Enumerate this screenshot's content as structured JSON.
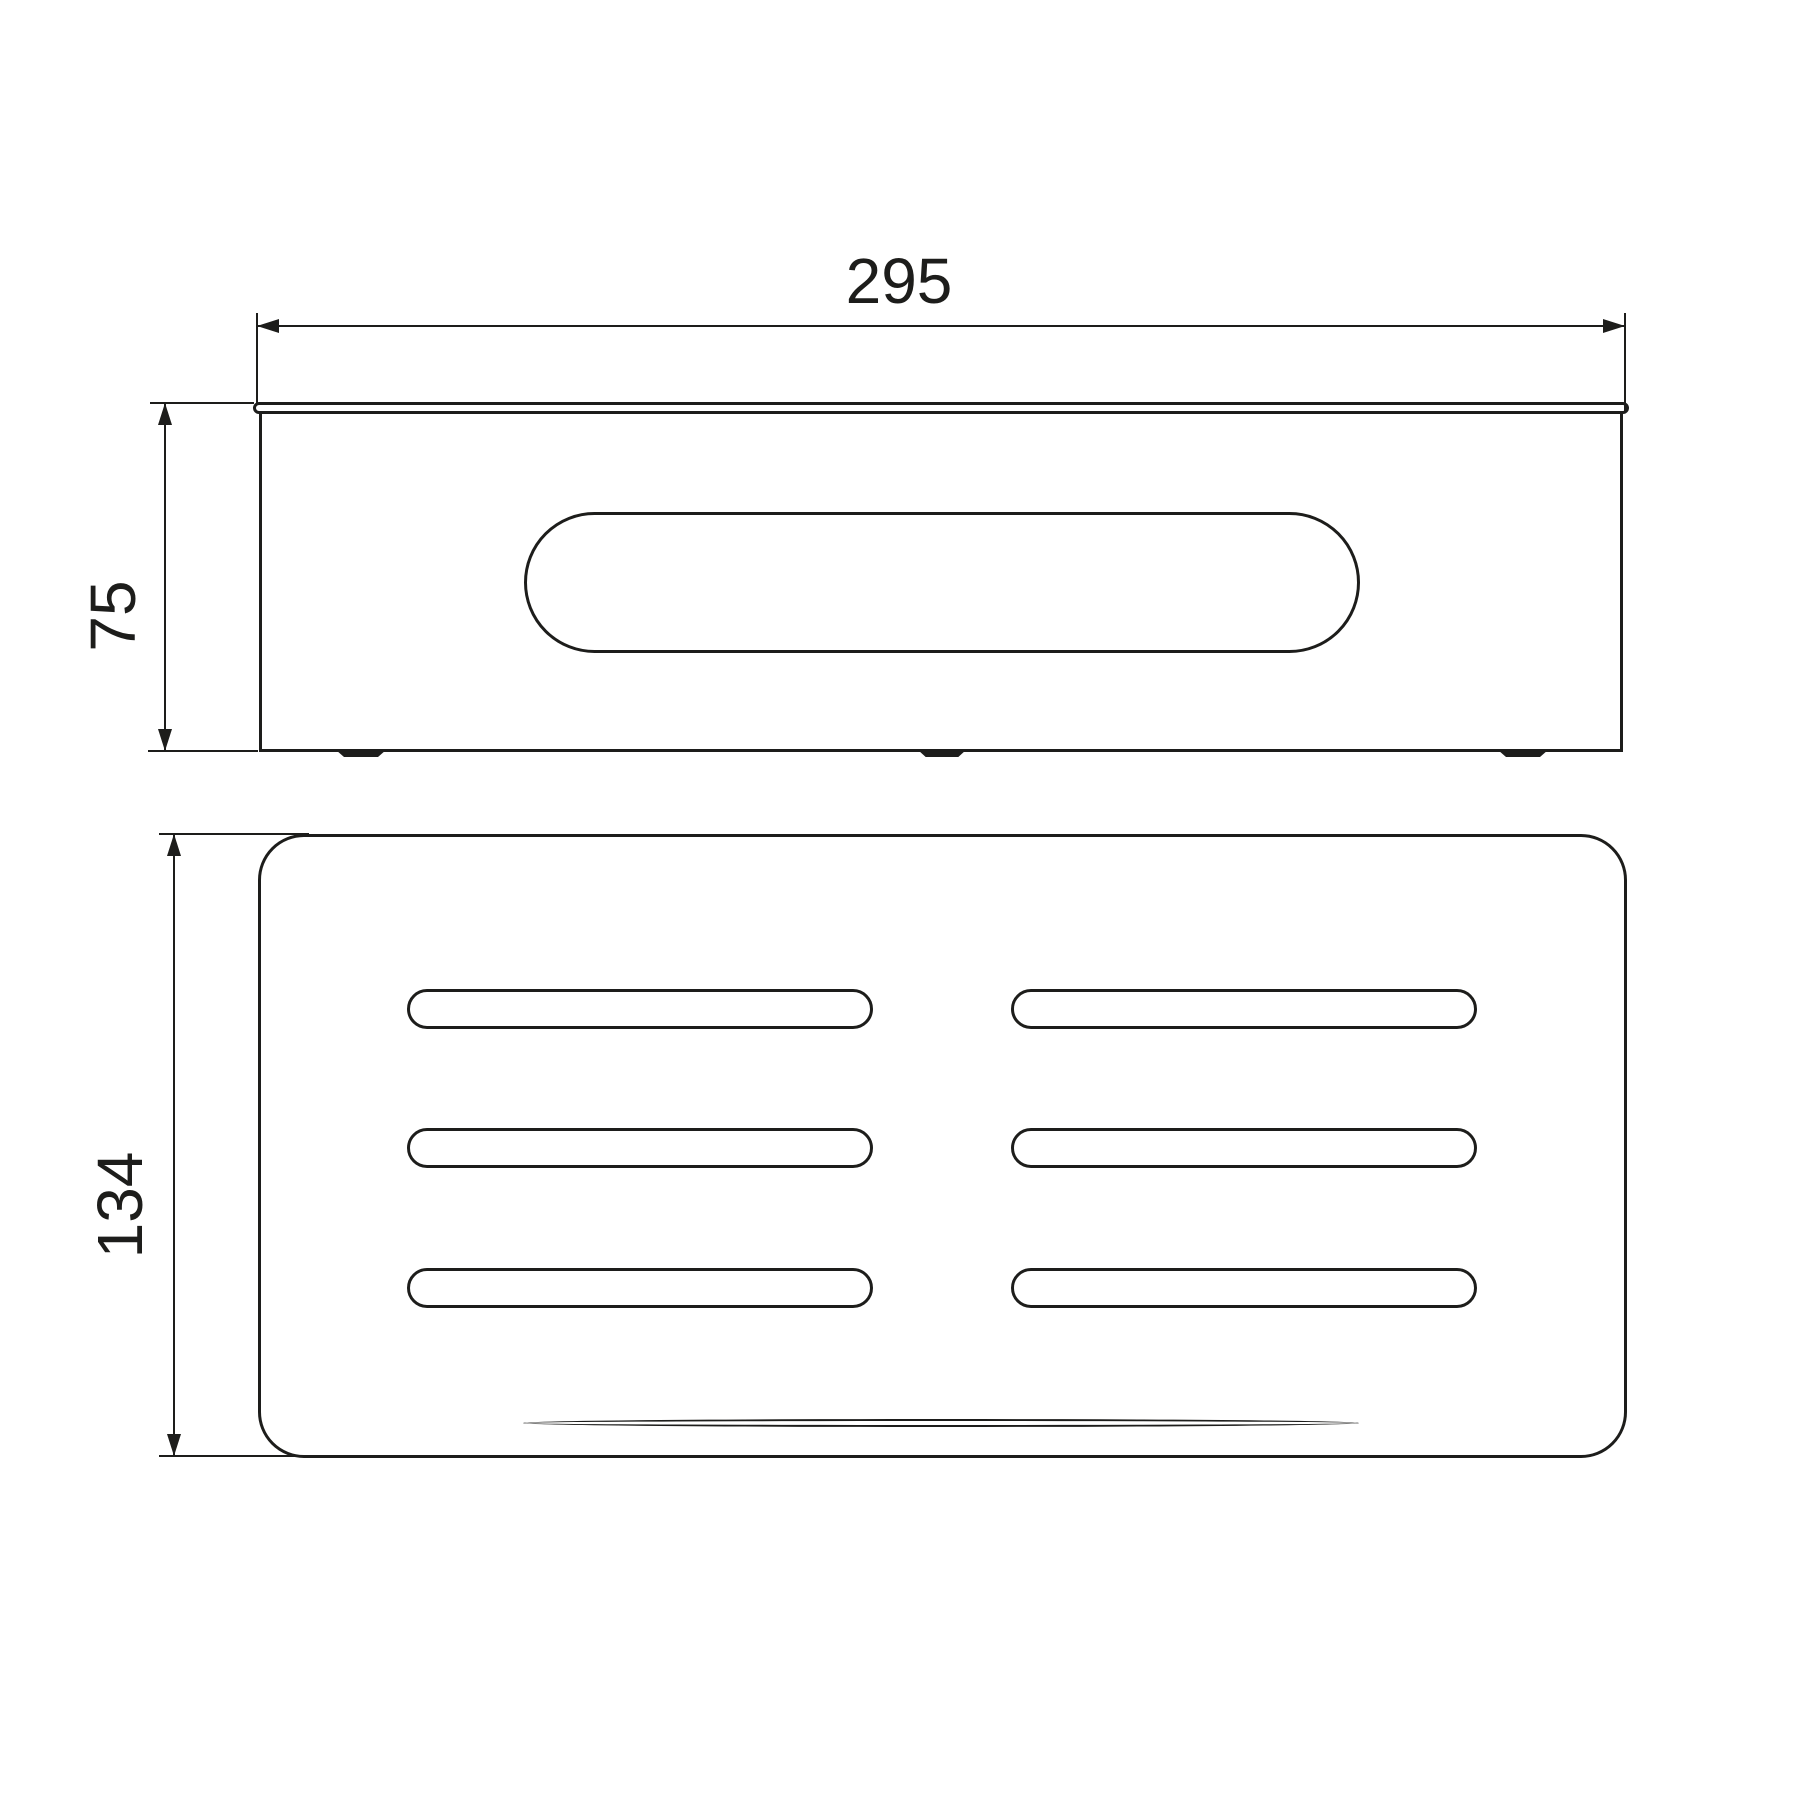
{
  "diagram": {
    "type": "technical-drawing",
    "dimensions": {
      "width": {
        "label": "295"
      },
      "height": {
        "label": "75"
      },
      "depth": {
        "label": "134"
      }
    },
    "colors": {
      "line": "#1d1d1b",
      "background": "#ffffff"
    }
  }
}
